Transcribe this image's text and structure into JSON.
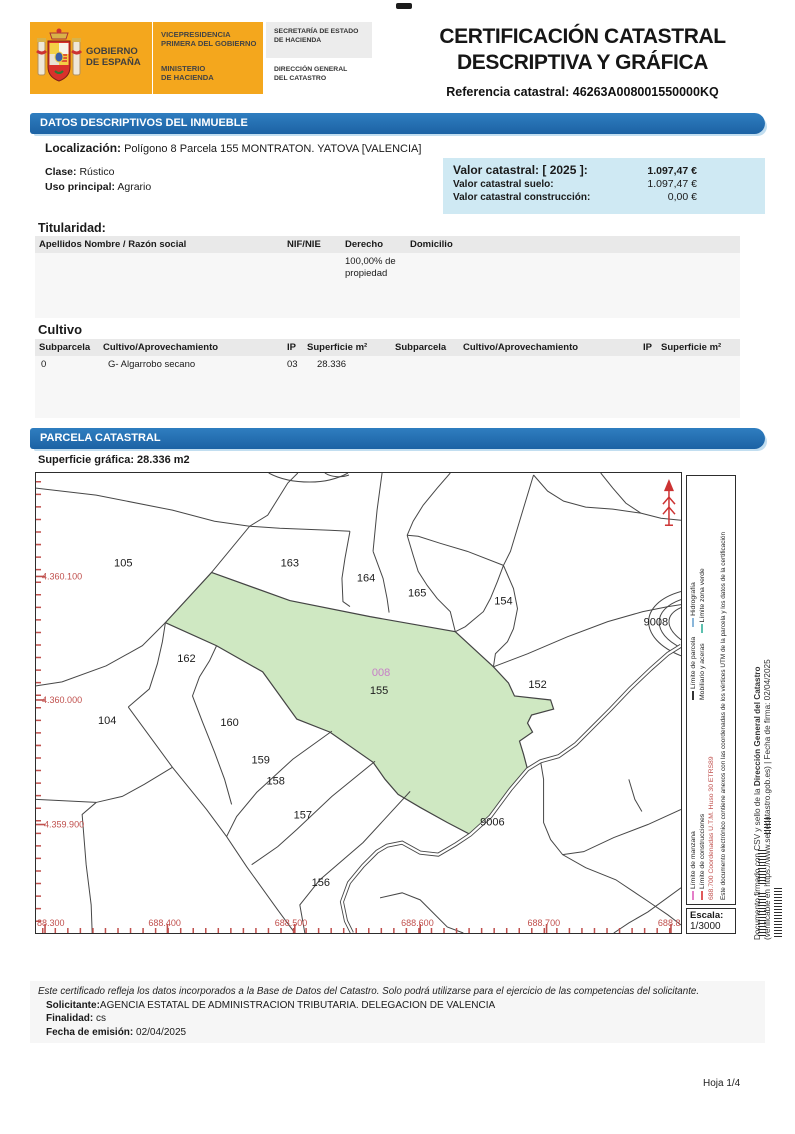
{
  "header": {
    "logo": {
      "gob1": "GOBIERNO",
      "gob2": "DE ESPAÑA",
      "vice1": "VICEPRESIDENCIA",
      "vice2": "PRIMERA DEL GOBIERNO",
      "min1": "MINISTERIO",
      "min2": "DE HACIENDA",
      "sec1a": "SECRETARÍA DE ESTADO",
      "sec1b": "DE HACIENDA",
      "sec2a": "DIRECCIÓN GENERAL",
      "sec2b": "DEL CATASTRO"
    },
    "title1": "CERTIFICACIÓN CATASTRAL",
    "title2": "DESCRIPTIVA Y GRÁFICA",
    "ref_label": "Referencia catastral:",
    "ref_value": "46263A008001550000KQ"
  },
  "bars": {
    "datos": "DATOS DESCRIPTIVOS DEL INMUEBLE",
    "parcela": "PARCELA CATASTRAL"
  },
  "datos": {
    "localizacion_label": "Localización:",
    "localizacion_value": "Polígono 8 Parcela 155 MONTRATON. YATOVA [VALENCIA]",
    "clase_label": "Clase:",
    "clase_value": "Rústico",
    "uso_label": "Uso principal:",
    "uso_value": "Agrario"
  },
  "valor": {
    "row1_label": "Valor catastral: [ 2025 ]:",
    "row1_value": "1.097,47 €",
    "row2_label": "Valor catastral suelo:",
    "row2_value": "1.097,47 €",
    "row3_label": "Valor catastral construcción:",
    "row3_value": "0,00 €"
  },
  "titularidad": {
    "title": "Titularidad:",
    "headers": [
      "Apellidos Nombre / Razón social",
      "NIF/NIE",
      "Derecho",
      "Domicilio"
    ],
    "derecho_value": "100,00% de propiedad"
  },
  "cultivo": {
    "title": "Cultivo",
    "headers": [
      "Subparcela",
      "Cultivo/Aprovechamiento",
      "IP",
      "Superficie m²"
    ],
    "row": {
      "subparcela": "0",
      "cultivo": "G- Algarrobo secano",
      "ip": "03",
      "superficie": "28.336"
    }
  },
  "parcela": {
    "superficie_label": "Superficie gráfica:",
    "superficie_value": "28.336 m2"
  },
  "map": {
    "labels": [
      "105",
      "163",
      "164",
      "165",
      "154",
      "9008",
      "162",
      "152",
      "104",
      "160",
      "159",
      "158",
      "157",
      "156",
      "155",
      "008",
      "9006"
    ],
    "coords_left": [
      "4.360.100",
      "4.360.000",
      "4.359.900"
    ],
    "coords_bottom": [
      "88.300",
      "688.400",
      "688.500",
      "688.600",
      "688.700",
      "688.8"
    ]
  },
  "legend": {
    "parcela": "Límite de parcela",
    "hidrografia": "Hidrografía",
    "mobiliario": "Mobiliario y aceras",
    "zona_verde": "Límite zona verde",
    "manzana": "Límite de manzana",
    "construcciones": "Límite de construcciones",
    "coordenadas": "688.700 Coordenadas U.T.M. Huso 30 ETRS89",
    "nota": "Este documento electrónico contiene anexos con las coordenadas de los vértices UTM de la parcela y los datos de la certificación"
  },
  "escala": {
    "label": "Escala:",
    "value": "1/3000"
  },
  "footer": {
    "disclaimer": "Este certificado refleja los datos incorporados a la Base de Datos del Catastro. Solo podrá utilizarse para el ejercicio de las competencias del solicitante.",
    "solicitante_label": "Solicitante:",
    "solicitante_value": "AGENCIA ESTATAL DE ADMINISTRACION TRIBUTARIA. DELEGACION DE VALENCIA",
    "finalidad_label": "Finalidad:",
    "finalidad_value": "cs",
    "fecha_label": "Fecha de emisión:",
    "fecha_value": "02/04/2025",
    "hoja": "Hoja 1/4"
  },
  "margin": {
    "line1a": "Documento firmado con CSV y sello de la ",
    "line1b": "Dirección General del Catastro",
    "line2": "(verificable en https://www.sedecatastro.gob.es)   |   Fecha de firma: 02/04/2025"
  },
  "colors": {
    "header_yellow": "#f4a71d",
    "section_blue": "#2272b8",
    "valor_bg": "#cfe9f3",
    "parcel_green": "#cfe8c2",
    "map_red": "#c0504d",
    "highlight_magenta": "#c77fc7"
  }
}
